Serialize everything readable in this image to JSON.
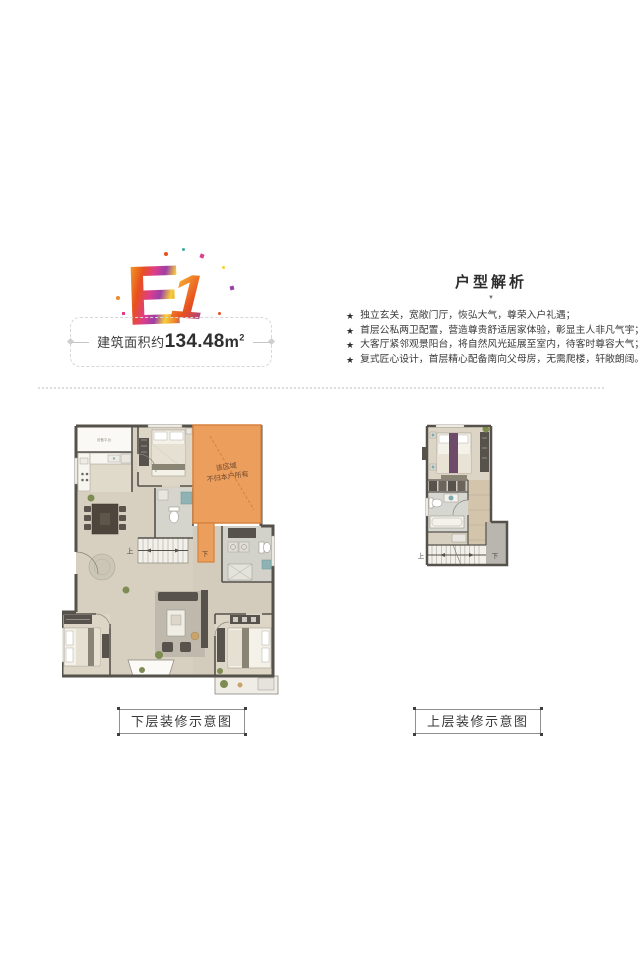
{
  "logo": {
    "letter_e": "E",
    "letter_one": "1"
  },
  "area": {
    "label": "建筑面积约",
    "value": "134.48",
    "unit_base": "m",
    "unit_sup": "2"
  },
  "analysis": {
    "title": "户型解析",
    "caret": "▼",
    "bullet_icon": "★",
    "bullets": [
      "独立玄关，宽敞门厅，恢弘大气，尊荣入户礼遇；",
      "首层公私两卫配置，营造尊贵舒适居家体验，彰显主人非凡气宇；",
      "大客厅紧邻观景阳台，将自然风光延展至室内，待客时尊容大气；",
      "复式匠心设计，首层精心配备南向父母房，无需爬楼，轩敞朗阔。"
    ]
  },
  "plans": {
    "lower": {
      "caption": "下层装修示意图",
      "notice_line1": "该区域",
      "notice_line2": "不归本户所有",
      "up_label": "上",
      "down_label": "下",
      "platform_label": "设备平台"
    },
    "upper": {
      "caption": "上层装修示意图",
      "up_label": "上",
      "down_label": "下"
    }
  },
  "colors": {
    "notice_orange": "#EC9E5C",
    "notice_orange_border": "#D8823B",
    "wall_dark": "#55514B",
    "floor_beige": "#D7D0C0",
    "page_background": "#FFFFFF"
  }
}
